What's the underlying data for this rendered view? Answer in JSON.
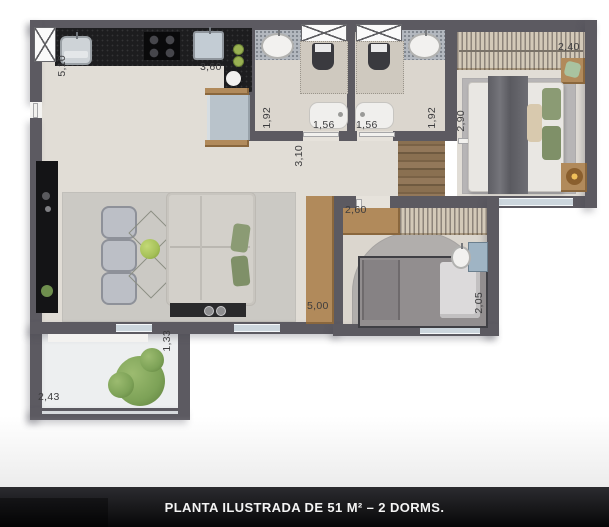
{
  "caption": {
    "text": "PLANTA ILUSTRADA DE 51 M² – 2 DORMS."
  },
  "dims": {
    "kitchen_h": "5,10",
    "kitchen_w": "3,60",
    "bath1_d": "1,92",
    "bath1_w": "1,56",
    "bath2_w": "1,56",
    "bath2_d": "1,92",
    "closet_w": "2,40",
    "suite_d": "2,90",
    "living_d": "3,10",
    "bed2_w": "2,60",
    "living_l": "5,00",
    "bed2_d": "2,05",
    "balcony_d": "1,33",
    "balcony_w": "2,43"
  },
  "colors": {
    "wall": "#5c5a61",
    "floor": "#e1ddd6",
    "wood_floor": "#8a7051",
    "counter": "#1d1d1f",
    "glass": "#ccd6dd",
    "greenery": "#7da257",
    "caption_bg": "#121214",
    "caption_text": "#f4f4f4"
  },
  "furniture_icons": [
    "washing-machine-icon",
    "laundry-sink-icon",
    "stove-icon",
    "kitchen-sink-icon",
    "refrigerator-icon",
    "tv-panel-icon",
    "dining-chair-icon",
    "dining-table-icon",
    "sofa-icon",
    "tv-console-icon",
    "sideboard-icon",
    "shower-icon",
    "toilet-icon",
    "washbasin-icon",
    "bathtub-icon",
    "closet-clothes-icon",
    "double-bed-icon",
    "nightstand-icon",
    "table-lamp-icon",
    "single-bed-icon",
    "desk-icon",
    "desk-chair-icon",
    "plant-icon"
  ]
}
